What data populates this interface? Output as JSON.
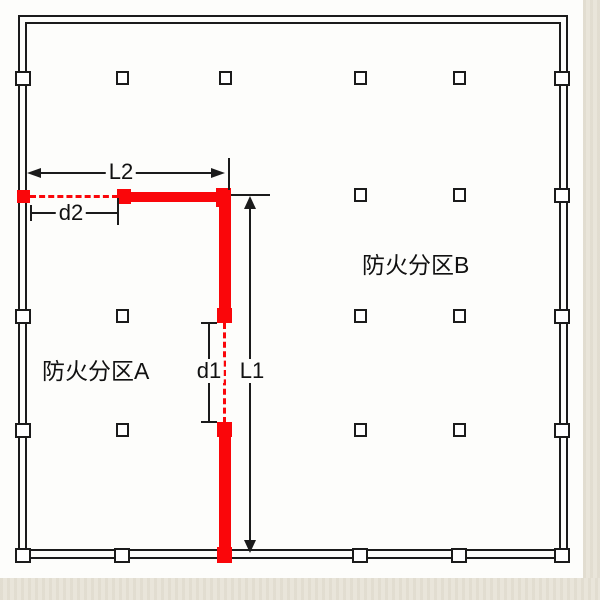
{
  "page": {
    "background_color": "#ffffff",
    "margin_color": "#e8e4d8",
    "plan_color": "#fdfdfb"
  },
  "plan": {
    "zone_a": "防火分区A",
    "zone_b": "防火分区B",
    "dims": {
      "L2": "L2",
      "d2": "d2",
      "d1": "d1",
      "L1": "L1"
    },
    "colors": {
      "firewall_red": "#fa060a",
      "line_black": "#1b1b1b"
    },
    "columns": {
      "interior": [
        [
          122,
          78
        ],
        [
          225,
          78
        ],
        [
          360,
          78
        ],
        [
          459,
          78
        ],
        [
          360,
          195
        ],
        [
          459,
          195
        ],
        [
          122,
          316
        ],
        [
          360,
          316
        ],
        [
          459,
          316
        ],
        [
          122,
          430
        ],
        [
          360,
          430
        ],
        [
          459,
          430
        ]
      ],
      "wall": [
        [
          23,
          78
        ],
        [
          23,
          316
        ],
        [
          23,
          430
        ],
        [
          562,
          78
        ],
        [
          562,
          195
        ],
        [
          562,
          316
        ],
        [
          562,
          430
        ],
        [
          23,
          555
        ],
        [
          122,
          555
        ],
        [
          360,
          555
        ],
        [
          459,
          555
        ],
        [
          562,
          555
        ]
      ]
    },
    "firewall_squares": [
      [
        17,
        190,
        13,
        13
      ],
      [
        117,
        189,
        14,
        15
      ],
      [
        216,
        188,
        15,
        19
      ],
      [
        217,
        308,
        15,
        15
      ],
      [
        217,
        422,
        15,
        15
      ],
      [
        217,
        547,
        15,
        16
      ]
    ]
  }
}
